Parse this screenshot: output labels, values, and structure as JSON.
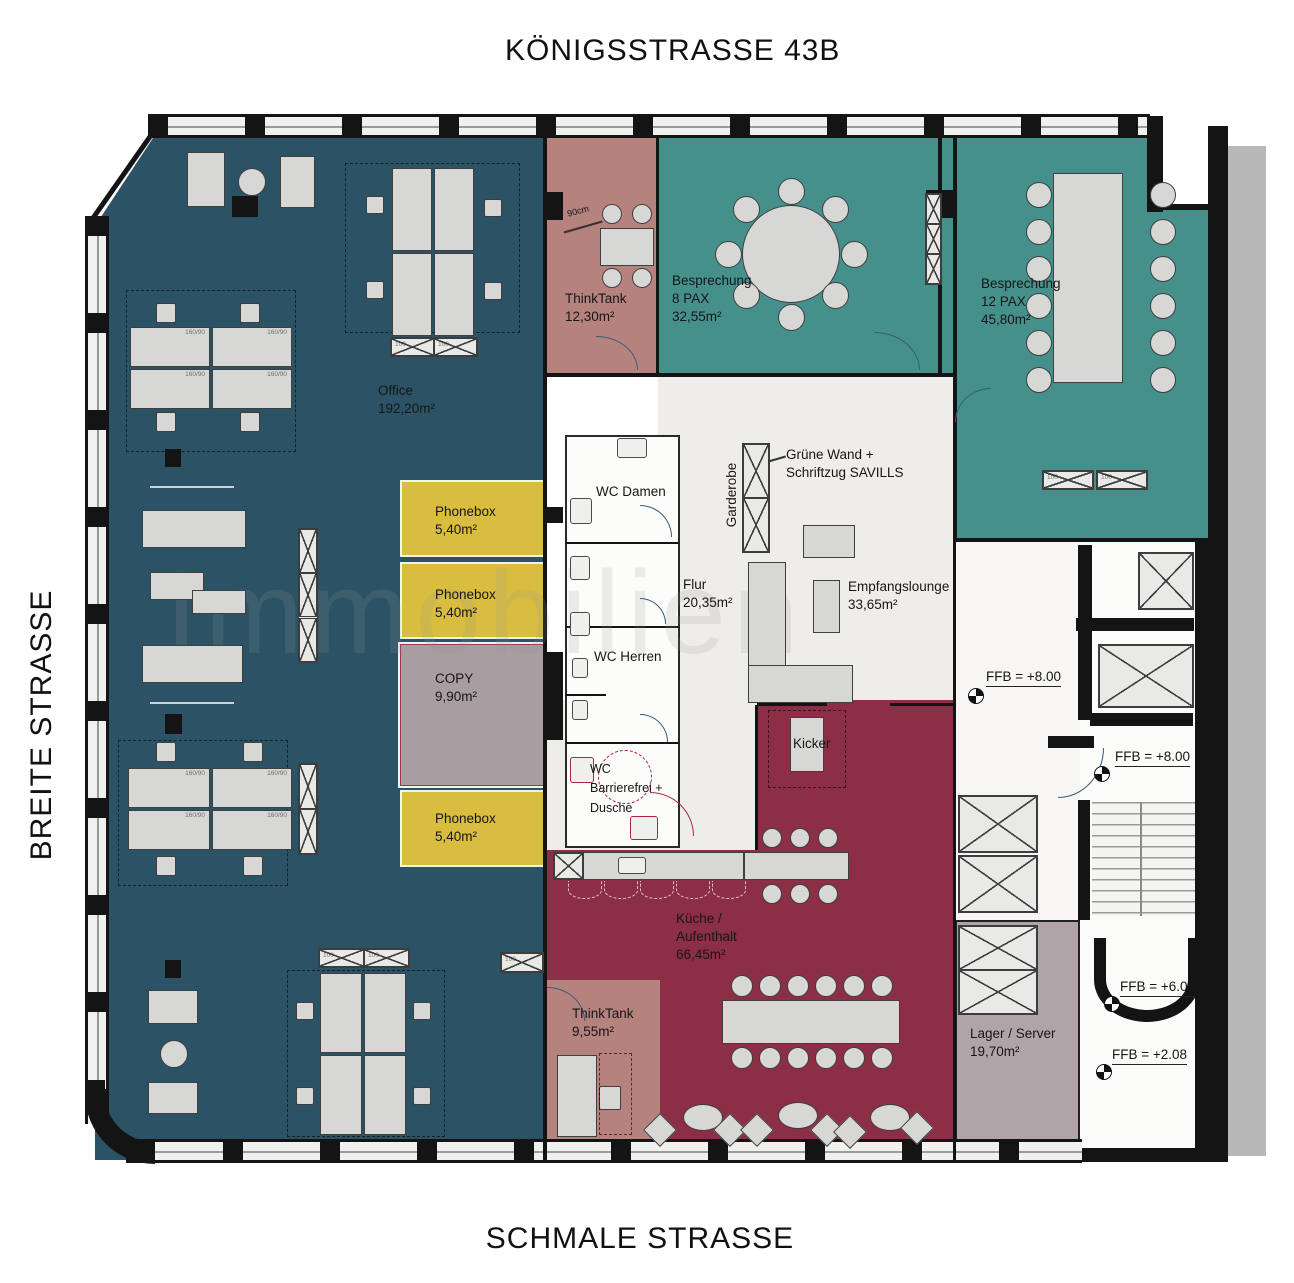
{
  "streets": {
    "top": "KÖNIGSSTRASSE 43B",
    "left": "BREITE STRASSE",
    "bottom": "SCHMALE STRASSE"
  },
  "watermark": "Immobilien",
  "rooms": {
    "office": {
      "name": "Office",
      "area": "192,20m²"
    },
    "thinktank_top": {
      "name": "ThinkTank",
      "area": "12,30m²"
    },
    "besprechung_8": {
      "name": "Besprechung",
      "pax": "8 PAX",
      "area": "32,55m²"
    },
    "besprechung_12": {
      "name": "Besprechung",
      "pax": "12 PAX",
      "area": "45,80m²"
    },
    "phonebox": {
      "name": "Phonebox",
      "area": "5,40m²"
    },
    "copy": {
      "name": "COPY",
      "area": "9,90m²"
    },
    "wc_damen": {
      "name": "WC Damen"
    },
    "wc_herren": {
      "name": "WC Herren"
    },
    "wc_barrierefrei": {
      "line1": "WC",
      "line2": "Barrierefrei +",
      "line3": "Dusche"
    },
    "flur": {
      "name": "Flur",
      "area": "20,35m²"
    },
    "garderobe": {
      "name": "Garderobe"
    },
    "gruene_wand": {
      "line1": "Grüne Wand +",
      "line2": "Schriftzug SAVILLS"
    },
    "empfangslounge": {
      "name": "Empfangslounge",
      "area": "33,65m²"
    },
    "kicker": {
      "name": "Kicker"
    },
    "kueche": {
      "line1": "Küche /",
      "line2": "Aufenthalt",
      "area": "66,45m²"
    },
    "thinktank_bottom": {
      "name": "ThinkTank",
      "area": "9,55m²"
    },
    "lager": {
      "name": "Lager / Server",
      "area": "19,70m²"
    }
  },
  "levels": {
    "ffb_8_upper": "FFB = +8.00",
    "ffb_8_lower": "FFB = +8.00",
    "ffb_6": "FFB = +6.01",
    "ffb_2": "FFB = +2.08"
  },
  "dimensions": {
    "door_width": "90cm",
    "desk": "160/90",
    "sideboard": "100"
  },
  "colors": {
    "office": "#2c5365",
    "meeting": "#46908c",
    "thinktank": "#b5827e",
    "phonebox": "#d9bd3f",
    "copy": "#a89da1",
    "kueche": "#8c2e45",
    "lager": "#b1a4a9",
    "flur": "#efedea",
    "wall": "#141414",
    "exterior": "#b8b8b8"
  }
}
